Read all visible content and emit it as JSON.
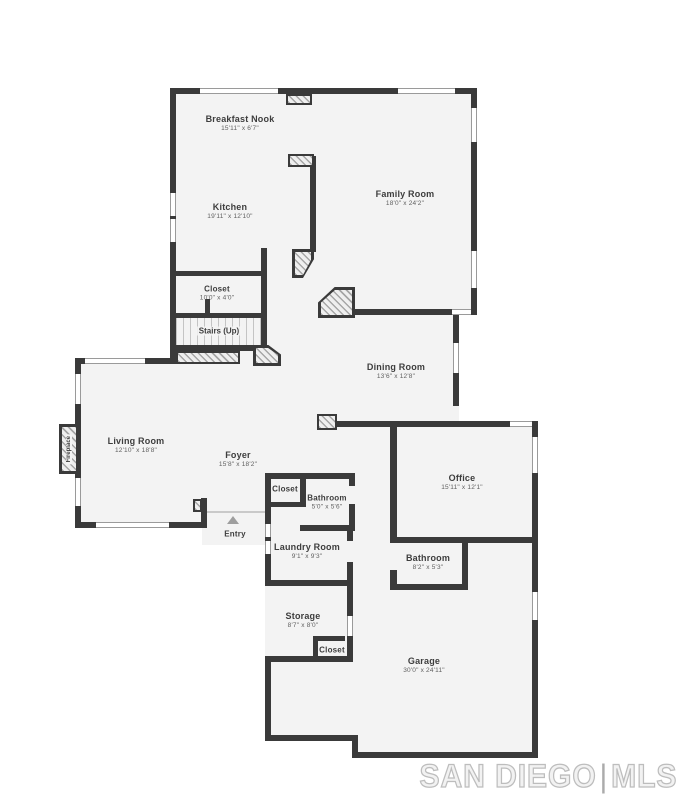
{
  "watermark": {
    "primary": "SAN DIEGO",
    "separator": "|",
    "secondary": "MLS"
  },
  "palette": {
    "wall": "#3a3a3a",
    "floor": "#f3f3f3",
    "background": "#ffffff",
    "label": "#3d3d3d",
    "dimension_text": "#5f5f5f",
    "stair_tread": "#c4c4c4",
    "window_line": "#9a9a9a",
    "entry_arrow": "#9e9e9e",
    "watermark_outline": "#bdbdbd"
  },
  "rooms": {
    "breakfast_nook": {
      "name": "Breakfast Nook",
      "dims": "15'11\" x 6'7\""
    },
    "kitchen": {
      "name": "Kitchen",
      "dims": "19'11\" x 12'10\""
    },
    "family_room": {
      "name": "Family Room",
      "dims": "18'0\" x 24'2\""
    },
    "closet_upper": {
      "name": "Closet",
      "dims": "10'0\" x 4'0\""
    },
    "stairs": {
      "name": "Stairs (Up)"
    },
    "dining_room": {
      "name": "Dining Room",
      "dims": "13'6\" x 12'8\""
    },
    "living_room": {
      "name": "Living Room",
      "dims": "12'10\" x 18'8\""
    },
    "foyer": {
      "name": "Foyer",
      "dims": "15'8\" x 18'2\""
    },
    "closet_foyer": {
      "name": "Closet"
    },
    "bathroom_small": {
      "name": "Bathroom",
      "dims": "5'0\" x 5'6\""
    },
    "office": {
      "name": "Office",
      "dims": "15'11\" x 12'1\""
    },
    "laundry_room": {
      "name": "Laundry Room",
      "dims": "9'1\" x 9'3\""
    },
    "bathroom_lower": {
      "name": "Bathroom",
      "dims": "8'2\" x 5'3\""
    },
    "storage": {
      "name": "Storage",
      "dims": "8'7\" x 8'0\""
    },
    "closet_garage": {
      "name": "Closet"
    },
    "garage": {
      "name": "Garage",
      "dims": "30'0\" x 24'11\""
    },
    "fireplace": {
      "name": "Fireplace"
    },
    "entry": {
      "name": "Entry"
    }
  }
}
